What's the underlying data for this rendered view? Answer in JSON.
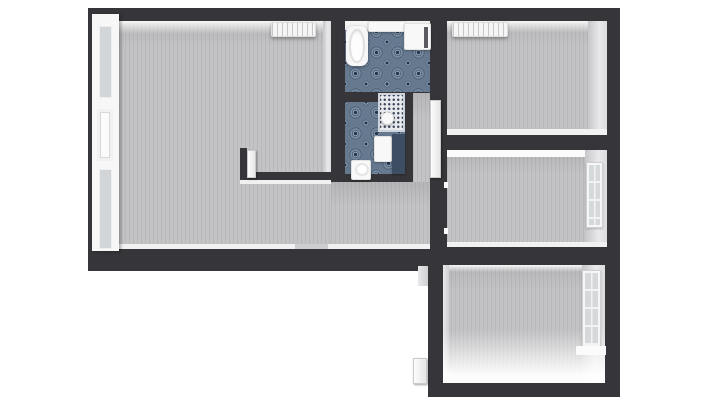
{
  "meta": {
    "kind": "3d-floor-plan-render",
    "canvas": {
      "w": 711,
      "h": 400
    },
    "background": "#ffffff"
  },
  "palette": {
    "wall": "#36363a",
    "carpet": "#c3c3c5",
    "tile_blue": "#66798f",
    "mosaic": "#e7e9ec",
    "fixture_white": "#f8f8f8",
    "dark_panel": "#3d4e63"
  },
  "scene": [
    {
      "name": "main-wall-slab",
      "cls": "slab",
      "x": 88,
      "y": 8,
      "w": 532,
      "h": 263
    },
    {
      "name": "lower-wall-slab",
      "cls": "slab",
      "x": 428,
      "y": 252,
      "w": 192,
      "h": 145
    },
    {
      "name": "living-room-floor",
      "cls": "carpet",
      "x": 101,
      "y": 21,
      "w": 230,
      "h": 226
    },
    {
      "name": "hall-south-floor",
      "cls": "carpet",
      "x": 331,
      "y": 182,
      "w": 99,
      "h": 65
    },
    {
      "name": "hall-corridor-floor",
      "cls": "carpet",
      "x": 413,
      "y": 93,
      "w": 17,
      "h": 89
    },
    {
      "name": "bathroom-floor",
      "cls": "tile-blue",
      "x": 345,
      "y": 21,
      "w": 85,
      "h": 71
    },
    {
      "name": "mosaic-hall-floor",
      "cls": "mosaic",
      "x": 378,
      "y": 93,
      "w": 27,
      "h": 39
    },
    {
      "name": "wc-floor-left",
      "cls": "tile-blue",
      "x": 345,
      "y": 102,
      "w": 33,
      "h": 72
    },
    {
      "name": "wc-floor-right",
      "cls": "tile-blue",
      "x": 378,
      "y": 132,
      "w": 27,
      "h": 42
    },
    {
      "name": "top-right-room-floor",
      "cls": "carpet",
      "x": 447,
      "y": 21,
      "w": 160,
      "h": 114
    },
    {
      "name": "mid-right-room-floor",
      "cls": "carpet",
      "x": 447,
      "y": 150,
      "w": 160,
      "h": 97
    },
    {
      "name": "lower-room-floor",
      "cls": "carpet",
      "x": 443,
      "y": 265,
      "w": 162,
      "h": 118
    },
    {
      "name": "living-top-wall-face",
      "cls": "face-top",
      "x": 101,
      "y": 21,
      "w": 230,
      "h": 13
    },
    {
      "name": "bathroom-top-shelf",
      "cls": "shelf",
      "x": 345,
      "y": 21,
      "w": 85,
      "h": 9
    },
    {
      "name": "topright-top-wall-face",
      "cls": "face-top",
      "x": 447,
      "y": 21,
      "w": 160,
      "h": 12
    },
    {
      "name": "topright-right-wall-face",
      "cls": "face-right",
      "x": 588,
      "y": 21,
      "w": 19,
      "h": 114
    },
    {
      "name": "topright-bottom-skirting",
      "cls": "skirt",
      "x": 447,
      "y": 129,
      "w": 160,
      "h": 6
    },
    {
      "name": "midright-top-wall-face",
      "cls": "skirt-bright",
      "x": 447,
      "y": 150,
      "w": 160,
      "h": 7
    },
    {
      "name": "midright-right-wall-face",
      "cls": "face-right",
      "x": 585,
      "y": 150,
      "w": 22,
      "h": 97
    },
    {
      "name": "midright-bottom-skirting",
      "cls": "skirt",
      "x": 447,
      "y": 242,
      "w": 160,
      "h": 5
    },
    {
      "name": "midcolumn-left-wall-face",
      "cls": "face-right",
      "x": 323,
      "y": 21,
      "w": 8,
      "h": 151
    },
    {
      "name": "living-bottom-skirting",
      "cls": "skirt",
      "x": 101,
      "y": 244,
      "w": 230,
      "h": 5
    },
    {
      "name": "living-door-threshold",
      "cls": "skirt-dim",
      "x": 295,
      "y": 244,
      "w": 33,
      "h": 5
    },
    {
      "name": "hall-south-skirting",
      "cls": "skirt",
      "x": 331,
      "y": 244,
      "w": 99,
      "h": 5
    },
    {
      "name": "lower-top-wall-face",
      "cls": "face-top",
      "x": 443,
      "y": 265,
      "w": 162,
      "h": 7
    },
    {
      "name": "lower-left-wall-face",
      "cls": "face-left",
      "x": 443,
      "y": 265,
      "w": 6,
      "h": 118
    },
    {
      "name": "lower-right-wall-face",
      "cls": "face-right",
      "x": 582,
      "y": 265,
      "w": 23,
      "h": 118
    },
    {
      "name": "lower-floor-light-glow",
      "cls": "glow",
      "x": 443,
      "y": 330,
      "w": 162,
      "h": 53
    },
    {
      "name": "lower-outer-wall-face",
      "cls": "face-left",
      "x": 418,
      "y": 266,
      "w": 10,
      "h": 20
    },
    {
      "name": "kitchen-wall-horizontal",
      "cls": "slab",
      "x": 240,
      "y": 172,
      "w": 91,
      "h": 8
    },
    {
      "name": "kitchen-wall-stub",
      "cls": "slab",
      "x": 240,
      "y": 148,
      "w": 7,
      "h": 32
    },
    {
      "name": "kitchen-wall-top-face",
      "cls": "skirt",
      "x": 240,
      "y": 180,
      "w": 91,
      "h": 4
    },
    {
      "name": "left-french-doors",
      "cls": "doorframe",
      "x": 92,
      "y": 14,
      "w": 27,
      "h": 237,
      "children": [
        {
          "name": "left-door-glass-upper",
          "cls": "glass",
          "x": 7,
          "y": 12,
          "w": 13,
          "h": 72
        },
        {
          "name": "left-door-recess-panel",
          "cls": "door-recess",
          "x": 5,
          "y": 95,
          "w": 16,
          "h": 52
        },
        {
          "name": "left-door-glass-lower",
          "cls": "glass",
          "x": 7,
          "y": 155,
          "w": 13,
          "h": 80
        }
      ]
    },
    {
      "name": "living-radiator",
      "cls": "radiator",
      "x": 271,
      "y": 22,
      "w": 45,
      "h": 15
    },
    {
      "name": "topright-radiator",
      "cls": "radiator",
      "x": 452,
      "y": 22,
      "w": 56,
      "h": 15
    },
    {
      "name": "bathtub",
      "cls": "tub",
      "x": 346,
      "y": 26,
      "w": 22,
      "h": 40,
      "children": [
        {
          "name": "bathtub-basin",
          "cls": "tub-basin",
          "x": 3,
          "y": 3,
          "w": 16,
          "h": 34
        }
      ]
    },
    {
      "name": "bathroom-counter",
      "cls": "fixture-white",
      "x": 368,
      "y": 21,
      "w": 38,
      "h": 11
    },
    {
      "name": "washing-machine",
      "cls": "fixture-white",
      "x": 404,
      "y": 23,
      "w": 27,
      "h": 27,
      "children": [
        {
          "name": "washing-machine-slot",
          "cls": "dark-slot",
          "x": 19,
          "y": 3,
          "w": 4,
          "h": 21
        }
      ]
    },
    {
      "name": "wc-sink",
      "cls": "fixture-white",
      "x": 374,
      "y": 136,
      "w": 18,
      "h": 26
    },
    {
      "name": "wc-shower-panel",
      "cls": "panel-dark",
      "x": 392,
      "y": 134,
      "w": 13,
      "h": 40
    },
    {
      "name": "toilet",
      "cls": "fixture-white",
      "x": 351,
      "y": 160,
      "w": 20,
      "h": 20,
      "children": [
        {
          "name": "toilet-bowl",
          "cls": "bowl",
          "x": 3,
          "y": 2,
          "w": 14,
          "h": 13
        }
      ]
    },
    {
      "name": "pedestal-sink",
      "cls": "fixture-round",
      "x": 381,
      "y": 112,
      "w": 13,
      "h": 13
    },
    {
      "name": "hallway-open-door",
      "cls": "door-panel",
      "x": 430,
      "y": 100,
      "w": 11,
      "h": 78
    },
    {
      "name": "kitchen-open-door",
      "cls": "door-panel",
      "x": 247,
      "y": 150,
      "w": 9,
      "h": 28
    },
    {
      "name": "midright-door-jamb-a",
      "cls": "skirt-bright",
      "x": 444,
      "y": 182,
      "w": 4,
      "h": 6
    },
    {
      "name": "midright-door-jamb-b",
      "cls": "skirt-bright",
      "x": 444,
      "y": 228,
      "w": 4,
      "h": 6
    },
    {
      "name": "midright-window",
      "cls": "window",
      "x": 586,
      "y": 162,
      "w": 17,
      "h": 66,
      "children": [
        {
          "name": "midright-window-glass",
          "cls": "window-glass",
          "x": 2,
          "y": 2,
          "w": 11,
          "h": 60
        }
      ]
    },
    {
      "name": "lower-window",
      "cls": "window",
      "x": 582,
      "y": 270,
      "w": 19,
      "h": 78,
      "children": [
        {
          "name": "lower-window-glass",
          "cls": "window-glass",
          "x": 2,
          "y": 2,
          "w": 13,
          "h": 72
        }
      ]
    },
    {
      "name": "lower-window-sill",
      "cls": "skirt-bright",
      "x": 576,
      "y": 346,
      "w": 30,
      "h": 9
    },
    {
      "name": "lower-outside-door",
      "cls": "door-panel",
      "x": 413,
      "y": 358,
      "w": 14,
      "h": 26
    }
  ]
}
